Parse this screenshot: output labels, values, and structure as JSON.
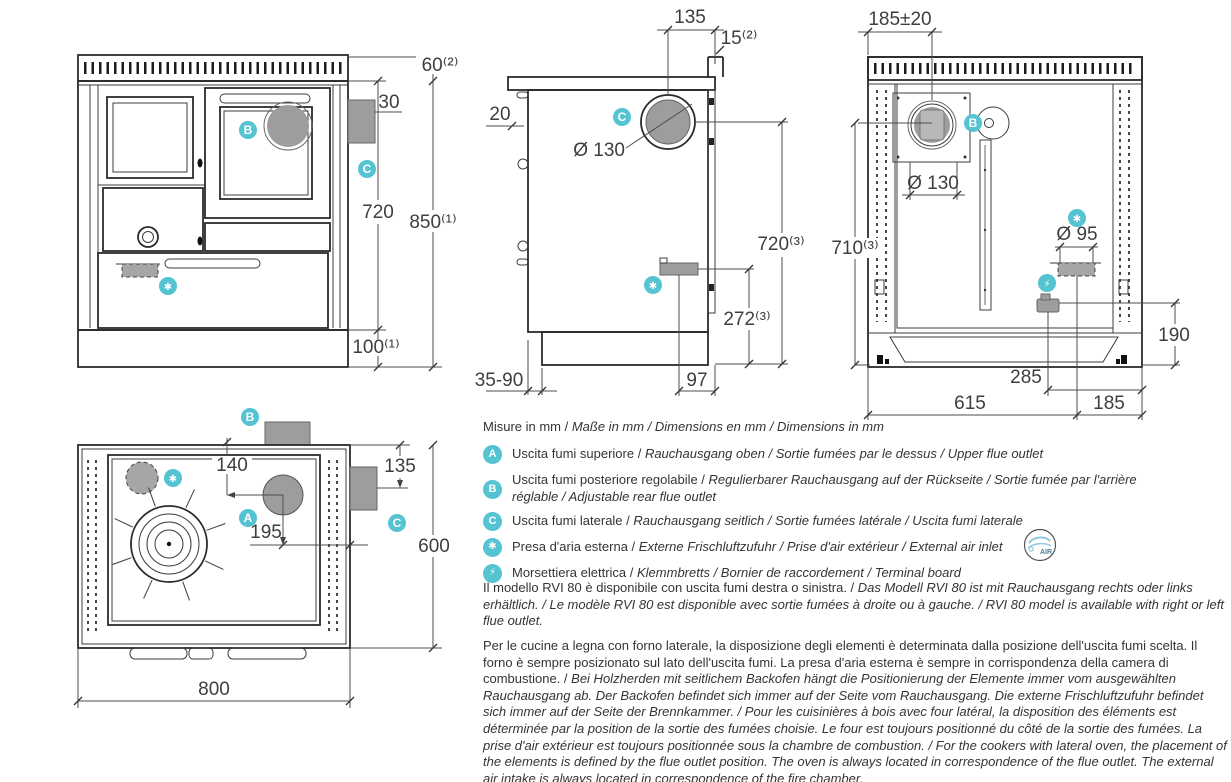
{
  "colors": {
    "accent": "#54c3d2",
    "grey": "#9d9d9d",
    "line": "#2b2b2b",
    "dim": "#4d4d4d",
    "text": "#343434",
    "air_blue": "#8fc6e0"
  },
  "badges": {
    "upper": "A",
    "rear": "B",
    "side": "C",
    "air": "✱",
    "electrical": "⚡"
  },
  "front": {
    "dims": {
      "worktop_height": "60⁽²⁾",
      "flue_offset": "30",
      "body_height": "720",
      "total_height": "850⁽¹⁾",
      "plinth_height": "100⁽¹⁾"
    }
  },
  "side": {
    "dims": {
      "flue_to_back": "135",
      "back_gap": "15⁽²⁾",
      "front_overhang": "20",
      "flue_diameter": "Ø 130",
      "flue_center_height": "720⁽³⁾",
      "air_inlet_height": "272⁽³⁾",
      "plinth_recess": "35-90",
      "air_to_back": "97"
    }
  },
  "rear": {
    "dims": {
      "flue_to_side": "185±20",
      "flue_diameter": "Ø 130",
      "flue_center_height": "710⁽³⁾",
      "air_diameter": "Ø 95",
      "terminal_height": "190",
      "terminal_span": "285",
      "air_from_left": "615",
      "air_from_right": "185"
    }
  },
  "top": {
    "dims": {
      "flue_to_edge": "140",
      "side_flue_offset": "135",
      "flue_to_back": "195",
      "depth": "600",
      "width": "800"
    }
  },
  "legend": {
    "title_roman": "Misure in mm / ",
    "title_italic": "Maße in mm / Dimensions en mm / Dimensions in mm",
    "air_logo_text": "AIR",
    "rows": [
      {
        "badge": "A",
        "roman": "Uscita fumi superiore / ",
        "italic": "Rauchausgang oben / Sortie fumées par le dessus / Upper flue outlet"
      },
      {
        "badge": "B",
        "roman": "Uscita fumi posteriore regolabile / ",
        "italic": "Regulierbarer Rauchausgang auf der Rückseite / Sortie fumée par l'arrière réglable / Adjustable rear flue outlet"
      },
      {
        "badge": "C",
        "roman": "Uscita fumi laterale / ",
        "italic": "Rauchausgang seitlich / Sortie fumées latérale / Uscita fumi laterale"
      },
      {
        "badge": "✱",
        "roman": "Presa d'aria esterna / ",
        "italic": "Externe Frischluftzufuhr / Prise d'air extérieur / External air inlet"
      },
      {
        "badge": "⚡",
        "roman": "Morsettiera elettrica / ",
        "italic": "Klemmbretts / Bornier de raccordement / Terminal board"
      }
    ]
  },
  "notes": {
    "availability_roman": "Il modello RVI 80 è disponibile con uscita fumi destra o sinistra. / ",
    "availability_italic": "Das Modell RVI 80 ist mit Rauchausgang rechts oder links erhältlich. / Le modèle RVI 80 est disponible avec sortie fumées à droite ou à gauche. / RVI 80 model is available with right or left flue outlet.",
    "layout_roman": "Per le cucine a legna con forno laterale, la disposizione degli elementi è determinata dalla posizione dell'uscita fumi scelta. Il forno è sempre posizionato sul lato dell'uscita fumi. La presa d'aria esterna è sempre in corrispondenza della camera di combustione. / ",
    "layout_italic": "Bei Holzherden mit seitlichem Backofen hängt die Positionierung der Elemente immer vom ausgewählten Rauchausgang ab. Der Backofen befindet sich immer auf der Seite vom Rauchausgang. Die externe Frischluftzufuhr befindet sich immer auf der Seite der Brennkammer. / Pour les cuisinières à bois avec four latéral, la disposition des éléments est déterminée par la position de la sortie des fumées choisie. Le four est toujours positionné du côté de la sortie des fumées. La prise d'air extérieur est toujours positionnée sous la chambre de combustion. / For the cookers with lateral oven, the placement of the elements is defined by the flue outlet position. The oven is always located in correspondence of the flue outlet. The external air intake is always located in correspondence of the fire chamber."
  }
}
